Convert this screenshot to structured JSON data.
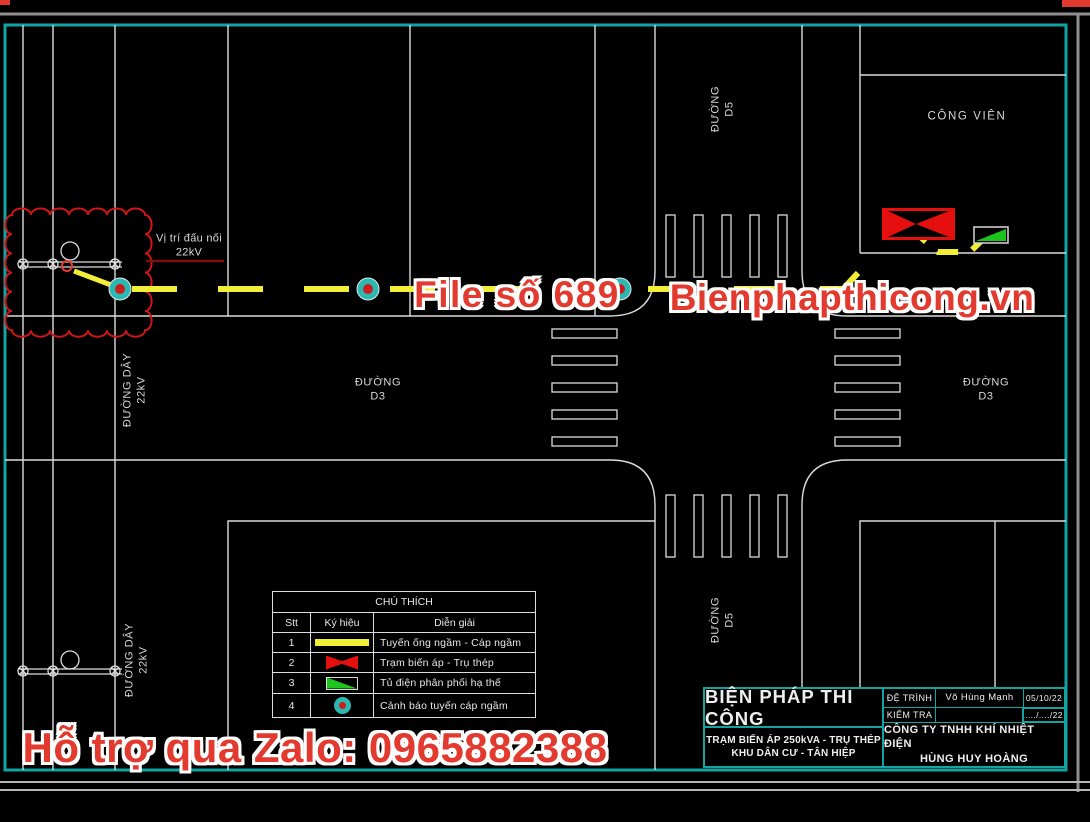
{
  "colors": {
    "background": "#000000",
    "linework_white": "#dcdcdc",
    "sheet_border_teal": "#10a5a2",
    "outer_frame_gray": "#8f8f8f",
    "cable_yellow": "#f2ee38",
    "watermark_red": "#e23a2e",
    "revision_cloud_red": "#cf1616",
    "leader_dark_red": "#7e0e0e",
    "transformer_red": "#e60f0f",
    "cabinet_green": "#1ec41e",
    "marker_teal": "#2cb8b2",
    "marker_core_red": "#cc1d1d"
  },
  "watermarks": {
    "file_no": "File số 689",
    "website": "Bienphapthicong.vn",
    "zalo": "Hỗ trợ qua Zalo: 0965882388"
  },
  "map_labels": {
    "park": "CÔNG VIÊN",
    "connection_line1": "Vị trí đấu nối",
    "connection_line2": "22kV",
    "road_d3_line1": "ĐƯỜNG",
    "road_d3_line2": "D3",
    "road_d5_line1": "ĐƯỜNG",
    "road_d5_line2": "D5",
    "power_line_line1": "ĐƯỜNG DÂY",
    "power_line_line2": "22kV"
  },
  "legend": {
    "title": "CHÚ THÍCH",
    "col_no": "Stt",
    "col_symbol": "Ký hiệu",
    "col_desc": "Diễn giải",
    "rows": [
      {
        "no": "1",
        "desc": "Tuyến ống ngầm - Cáp ngầm"
      },
      {
        "no": "2",
        "desc": "Trạm biến áp - Trụ thép"
      },
      {
        "no": "3",
        "desc": "Tủ điện phân phối hạ thế"
      },
      {
        "no": "4",
        "desc": "Cảnh báo tuyến cáp ngầm"
      }
    ]
  },
  "title_block": {
    "title": "BIỆN PHÁP THI CÔNG",
    "subtitle_line1": "TRẠM BIẾN ÁP 250kVA - TRỤ THÉP",
    "subtitle_line2": "KHU DÂN CƯ - TÂN HIỆP",
    "submit_label": "ĐỆ TRÌNH",
    "submit_name": "Võ Hùng Mạnh",
    "submit_date": "05/10/22",
    "check_label": "KIỂM TRA",
    "check_date": "..../..../22",
    "company_line1": "CÔNG TY TNHH KHÍ NHIỆT ĐIỆN",
    "company_line2": "HÙNG HUY HOÀNG"
  }
}
